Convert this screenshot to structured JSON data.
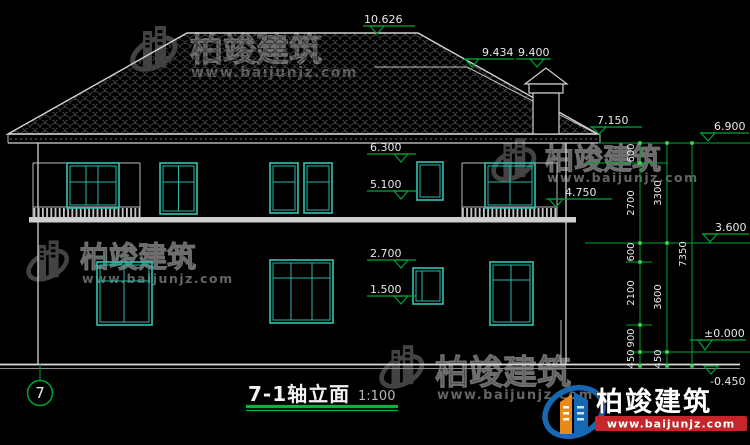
{
  "title": {
    "name": "7-1轴立面",
    "scale": "1:100",
    "axis_bubble": "7"
  },
  "levels": {
    "ridge": "10.626",
    "sub_ridge": "9.434",
    "chimney_top": "9.400",
    "main_eave": "7.150",
    "right_eave": "6.900",
    "f2_window_head": "6.300",
    "f2_window_sill": "5.100",
    "balcony_railing": "4.750",
    "second_floor": "3.600",
    "f1_window_head": "2.700",
    "f1_window_sill": "1.500",
    "ground_floor": "±0.000",
    "site_grade": "-0.450"
  },
  "dims": {
    "chain_inner": [
      "600",
      "2700",
      "600",
      "2100",
      "900",
      "450"
    ],
    "chain_middle": [
      "3300",
      "3600",
      "450"
    ],
    "chain_outer": [
      "7350"
    ]
  },
  "watermark": {
    "brand": "柏竣建筑",
    "url": "www.baijunjz.com"
  },
  "logo": {
    "brand": "柏竣建筑",
    "url": "www.baijunjz.com"
  },
  "colors": {
    "line": "#d2d2d2",
    "window": "#2eb8a8",
    "dimension": "#00a338",
    "logo_blue": "#1668b3",
    "logo_orange": "#e8891a",
    "logo_red": "#c5252b"
  }
}
